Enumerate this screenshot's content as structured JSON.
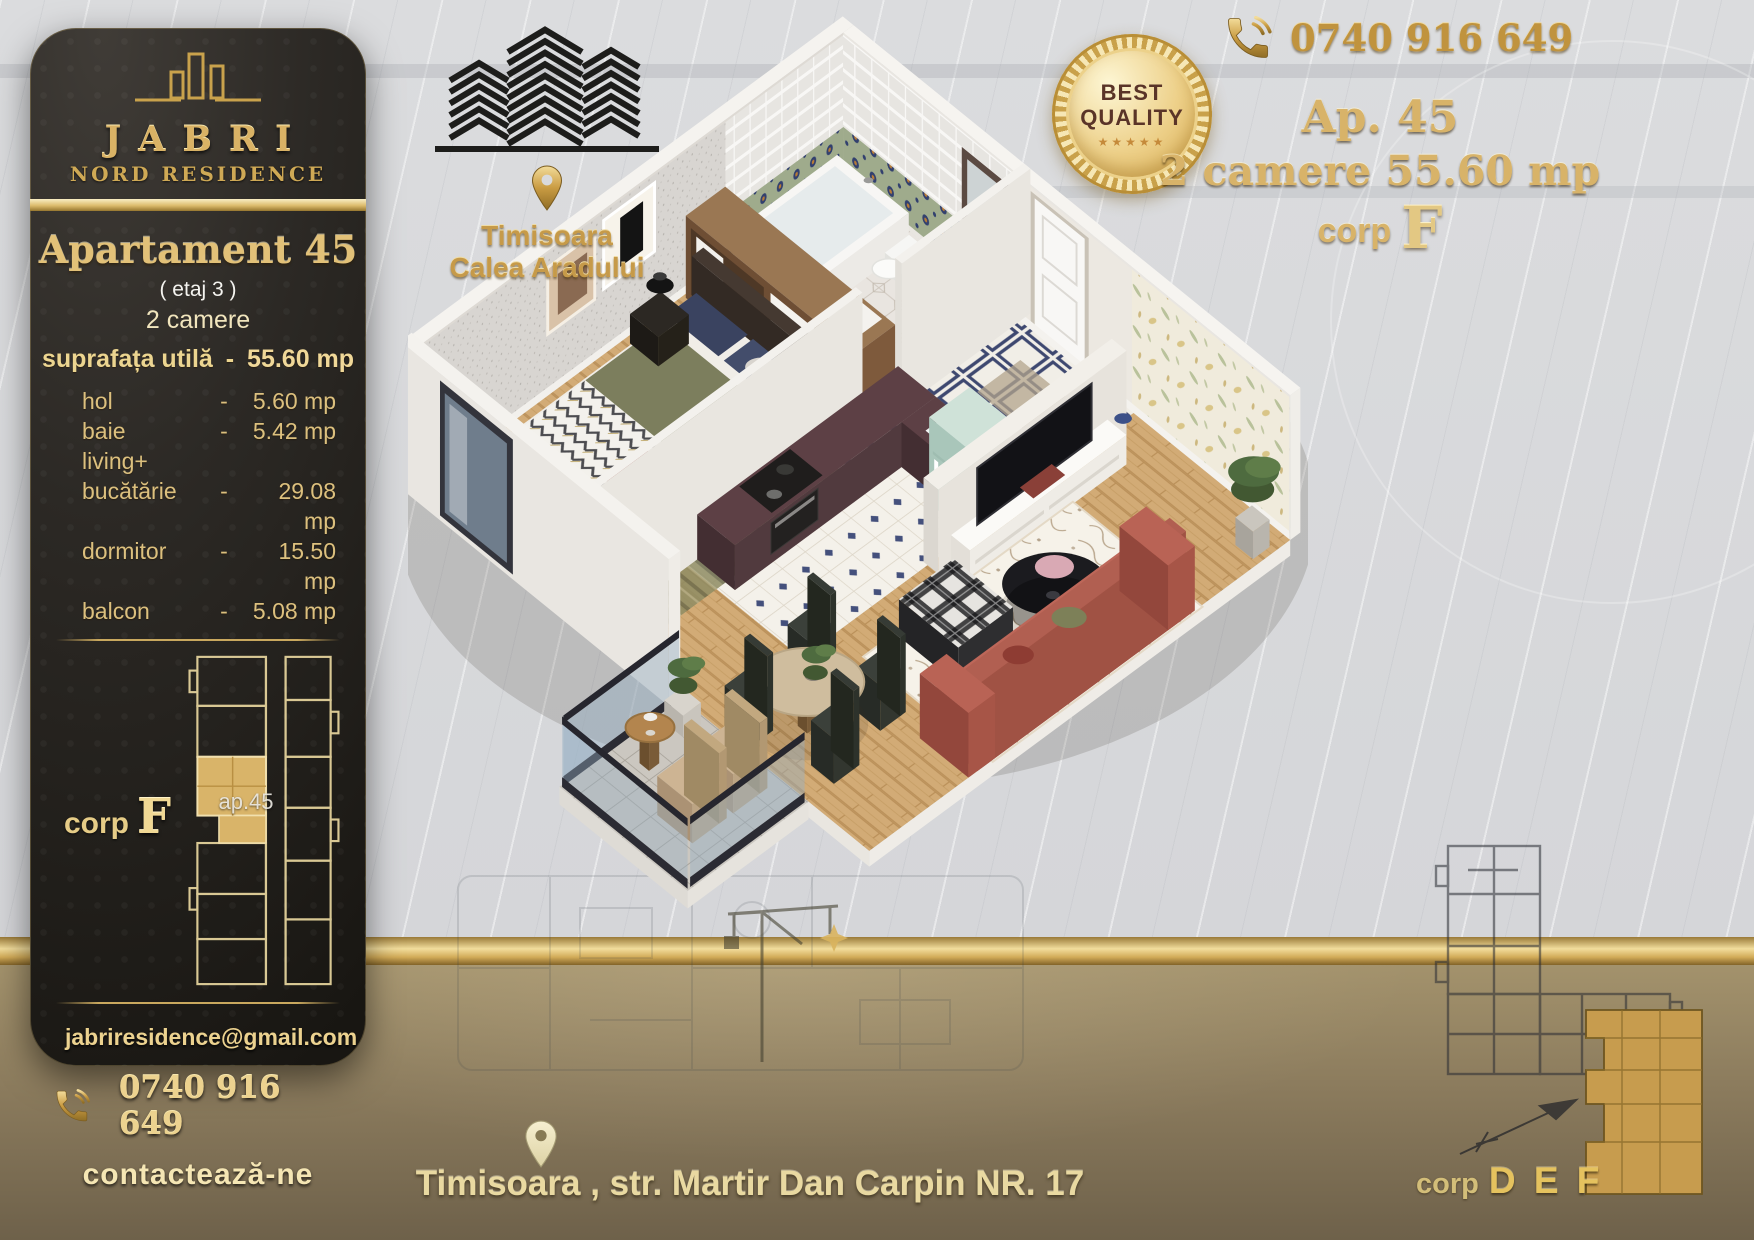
{
  "brand": {
    "name": "JABRI",
    "subtitle": "NORD RESIDENCE"
  },
  "left_panel": {
    "title": "Apartament 45",
    "floor": "( etaj 3 )",
    "rooms": "2 camere",
    "area_label": "suprafața utilă",
    "area_sep": "-",
    "area_value": "55.60 mp",
    "surfaces": [
      {
        "label": "hol",
        "sep": "-",
        "value": "5.60 mp"
      },
      {
        "label": "baie",
        "sep": "-",
        "value": "5.42 mp"
      },
      {
        "label": "living+",
        "sep": "",
        "value": ""
      },
      {
        "label": "bucătărie",
        "sep": "-",
        "value": "29.08 mp"
      },
      {
        "label": "dormitor",
        "sep": "-",
        "value": "15.50 mp"
      },
      {
        "label": "balcon",
        "sep": "-",
        "value": "5.08 mp"
      }
    ],
    "corp_label": "corp",
    "corp_letter": "F",
    "unit_label": "ap.45",
    "email": "jabriresidence@gmail.com",
    "phone": "0740 916 649",
    "cta": "contactează-ne"
  },
  "location_badge": {
    "city": "Timisoara",
    "street": "Calea Aradului"
  },
  "header": {
    "phone": "0740 916 649",
    "badge": {
      "line1": "BEST",
      "line2": "QUALITY",
      "stars": "★★★★★"
    },
    "apartment": "Ap. 45",
    "details": "2 camere 55.60 mp",
    "corp_label": "corp",
    "corp_letter": "F"
  },
  "footer": {
    "address": "Timisoara , str. Martir Dan Carpin NR. 17",
    "corp_label": "corp",
    "corp_letters": "D E F"
  },
  "icons": {
    "phone": "handset-with-waves",
    "envelope": "open-envelope-letter",
    "location_pin": "map-pin",
    "buildings": "chevron-towers",
    "badge": "best-quality-medallion",
    "north_arrow": "sketched-compass-arrow"
  },
  "colors": {
    "gold": "#d9b265",
    "gold_light": "#f2dd9c",
    "panel_dark": "#221f1b",
    "background_gray": "#d9dadc",
    "band_brown": "#8b7b5d",
    "highlight_tan": "#d9b469",
    "badge_text": "#5a3428"
  }
}
